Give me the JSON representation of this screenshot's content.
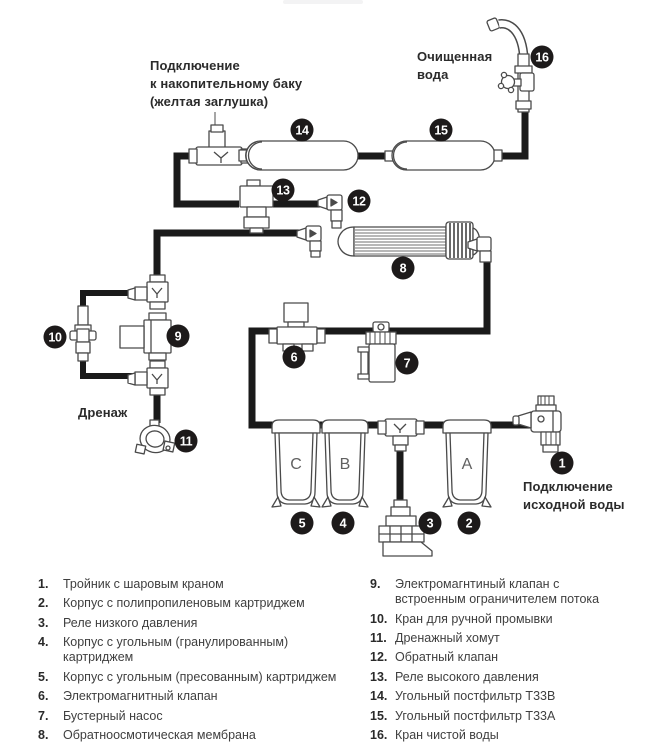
{
  "diagram": {
    "labels": {
      "tank": [
        "Подключение",
        "к накопительному баку",
        "(желтая заглушка)"
      ],
      "clean": [
        "Очищенная",
        "вода"
      ],
      "drain": "Дренаж",
      "source": [
        "Подключение",
        "исходной воды"
      ]
    },
    "housings": [
      "C",
      "B",
      "A"
    ],
    "badges": [
      "1",
      "2",
      "3",
      "4",
      "5",
      "6",
      "7",
      "8",
      "9",
      "10",
      "11",
      "12",
      "13",
      "14",
      "15",
      "16"
    ],
    "colors": {
      "badge": "#1d1a1a",
      "pipe": "#1a1a1a",
      "line_art": "#4a4a4a"
    }
  },
  "legend": {
    "left": [
      {
        "num": "1.",
        "text": "Тройник с шаровым краном"
      },
      {
        "num": "2.",
        "text": "Корпус с полипропиленовым картриджем"
      },
      {
        "num": "3.",
        "text": "Реле низкого давления"
      },
      {
        "num": "4.",
        "text": "Корпус с угольным (гранулированным) картриджем"
      },
      {
        "num": "5.",
        "text": "Корпус с угольным (пресованным) картриджем"
      },
      {
        "num": "6.",
        "text": "Электромагнитный клапан"
      },
      {
        "num": "7.",
        "text": "Бустерный насос"
      },
      {
        "num": "8.",
        "text": "Обратноосмотическая мембрана"
      }
    ],
    "right": [
      {
        "num": "9.",
        "text": "Электромагнтиный клапан с встроенным ограничителем потока"
      },
      {
        "num": "10.",
        "text": "Кран для ручной промывки"
      },
      {
        "num": "11.",
        "text": "Дренажный хомут"
      },
      {
        "num": "12.",
        "text": "Обратный клапан"
      },
      {
        "num": "13.",
        "text": "Реле высокого давления"
      },
      {
        "num": "14.",
        "text": "Угольный постфильтр Т33В"
      },
      {
        "num": "15.",
        "text": "Угольный постфильтр Т33А"
      },
      {
        "num": "16.",
        "text": "Кран чистой воды"
      }
    ]
  }
}
